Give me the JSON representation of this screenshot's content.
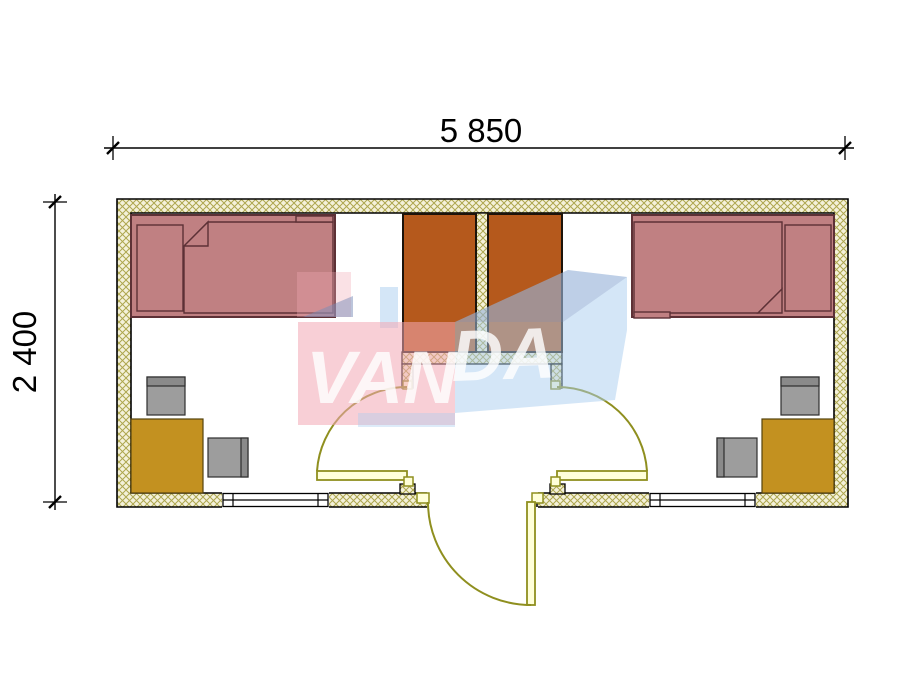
{
  "drawing": {
    "type": "floor-plan",
    "dimensions": {
      "width_label": "5 850",
      "height_label": "2 400"
    },
    "watermark": {
      "text": "VANDA",
      "front_text": "VAN",
      "side_text": "DA"
    },
    "colors": {
      "line": "#000000",
      "wall_fill": "#f4f1da",
      "wall_hatch": "#ada64e",
      "bed": "#c08082",
      "bed_outline": "#5d3136",
      "wardrobe": "#b5591c",
      "wardrobe_outline": "#1c130a",
      "desk": "#c39120",
      "desk_outline": "#55430d",
      "chair": "#9d9d9d",
      "chair_band": "#8a8a8a",
      "chair_outline": "#2e2e2e",
      "door": "#8f8f1f",
      "door_leaf": "#ffffd9",
      "watermark_pink": "#f2a8b4",
      "watermark_blue": "#aacdf0",
      "watermark_slate": "#7a8cb8",
      "watermark_text": "#ffffff"
    }
  }
}
